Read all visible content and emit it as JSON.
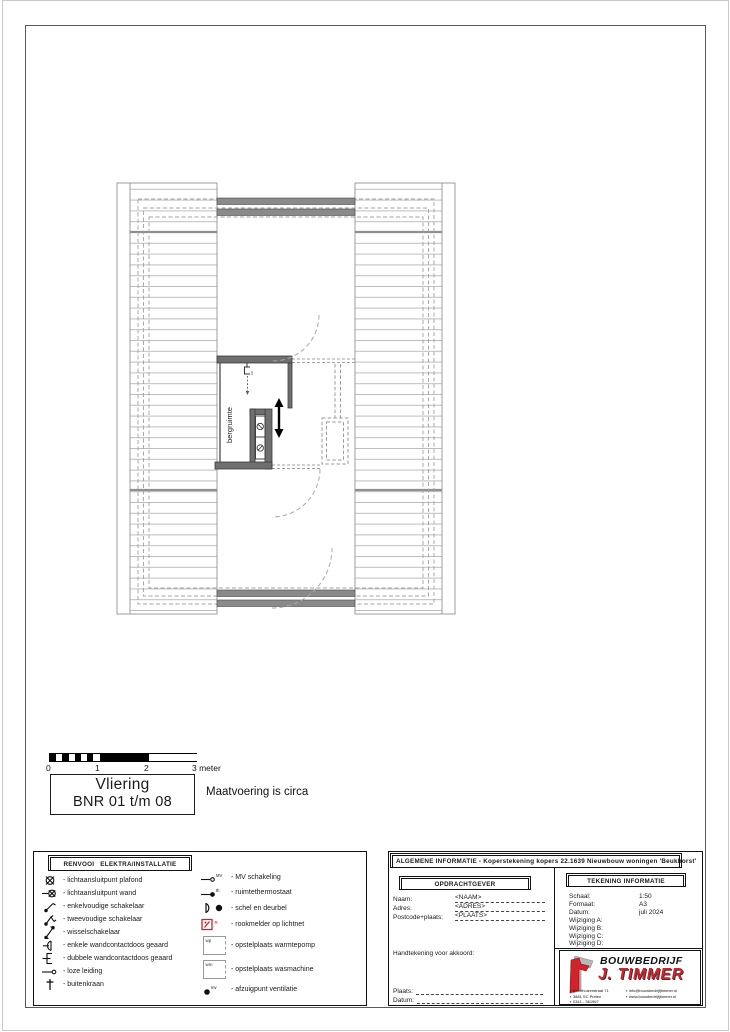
{
  "page": {
    "note": "Maatvoering is circa"
  },
  "scale_bar": {
    "ticks": [
      "0",
      "1",
      "2",
      "3 meter"
    ]
  },
  "title_box": {
    "line1": "Vliering",
    "line2": "BNR 01 t/m 08"
  },
  "plan": {
    "room_label": "bergruimte",
    "cv_label": "cv"
  },
  "legend": {
    "title": "RENVOOI   ELEKTRA/INSTALLATIE",
    "left_items": [
      "- lichtaansluitpunt plafond",
      "- lichtaansluitpunt wand",
      "- enkelvoudige schakelaar",
      "- tweevoudige schakelaar",
      "- wisselschakelaar",
      "- enkele wandcontactdoos geaard",
      "- dubbele wandcontactdoos geaard",
      "- loze leiding",
      "- buitenkraan"
    ],
    "right_items": [
      "- MV schakeling",
      "- ruimtethermostaat",
      "- schel en deurbel",
      "- rookmelder op lichtnet",
      "- opstelplaats warmtepomp",
      "- opstelplaats wasmachine",
      "- afzuigpunt ventilatie"
    ],
    "icon_labels": {
      "mv": "MV",
      "th": "th",
      "r": "R",
      "wp": "wp",
      "wm": "wm",
      "vent": "mv"
    }
  },
  "titleblock": {
    "header": "ALGEMENE INFORMATIE - Koperstekening kopers 22.1639 Nieuwbouw woningen 'Beukhorst'",
    "opdrachtgever": {
      "title": "OPDRACHTGEVER",
      "fields": [
        {
          "label": "Naam:",
          "value": "<NAAM>"
        },
        {
          "label": "Adres:",
          "value": "<ADRES>"
        },
        {
          "label": "Postcode+plaats:",
          "value": "<PLAATS>"
        }
      ],
      "signature_label": "Handtekening voor akkoord:",
      "plaats_label": "Plaats:",
      "datum_label": "Datum:"
    },
    "tekening": {
      "title": "TEKENING INFORMATIE",
      "rows": [
        {
          "label": "Schaal:",
          "value": "1:50"
        },
        {
          "label": "Formaat:",
          "value": "A3"
        },
        {
          "label": "Datum:",
          "value": "juli 2024"
        },
        {
          "label": "Wijziging A:",
          "value": ""
        },
        {
          "label": "Wijziging B:",
          "value": ""
        },
        {
          "label": "Wijziging C:",
          "value": ""
        },
        {
          "label": "Wijziging D:",
          "value": ""
        }
      ]
    },
    "logo": {
      "name_top": "BOUWBEDRIJF",
      "name_bottom": "J. TIMMER",
      "contact_left": [
        "Voorthuizerstraat 71",
        "3881 SC Putten",
        "0341 - 361967"
      ],
      "contact_right": [
        "info@bouwbedrijfjtimmer.nl",
        "www.bouwbedrijfjtimmer.nl"
      ]
    },
    "colors": {
      "logo_red": "#d2232a",
      "smoke_red": "#cc2128"
    }
  }
}
